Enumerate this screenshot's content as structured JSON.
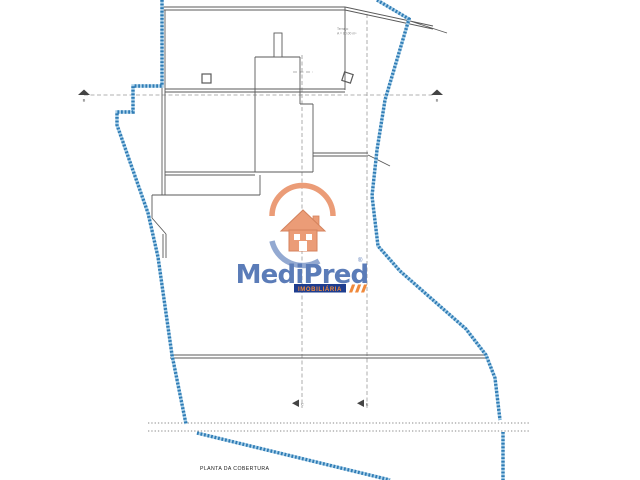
{
  "drawing": {
    "title": "PLANTA DA COBERTURA",
    "annotation": {
      "line1": "Terraço",
      "line2": "A = 80.00 m²"
    },
    "section_markers": {
      "top_left": "B",
      "top_right": "B",
      "bottom_left": "C",
      "bottom_right": "E"
    },
    "colors": {
      "boundary_blue": "#2f7cb5",
      "boundary_light": "#a8cfe8",
      "line_gray": "#5a5a5a",
      "centerline_gray": "#999999"
    }
  },
  "logo": {
    "brand": "MediPred",
    "trademark": "®",
    "tagline": "IMOBILIÁRIA",
    "colors": {
      "orange": "#eb9c77",
      "text_blue": "#5b7cb8",
      "arc_blue": "#93a9d1",
      "bar_navy": "#1e3d8f",
      "tagline_orange": "#f08a3c"
    }
  }
}
